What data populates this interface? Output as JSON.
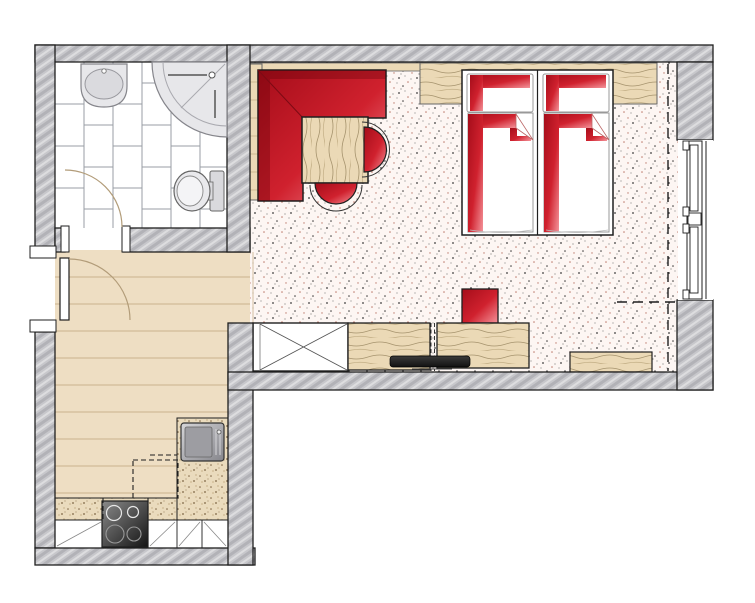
{
  "colors": {
    "outline": "#1f1f1f",
    "wall_base": "#c7c7cb",
    "wall_dark": "#b2b2b7",
    "wall_light": "#dddddf",
    "red_dark": "#a50d1a",
    "red_mid": "#d0212e",
    "red_light": "#f4939a",
    "wood_floor": "#eedec3",
    "wood_floor_line": "#c9b28c",
    "wood_base": "#ebd9b6",
    "wood_grain": "#8d7b54",
    "wood_grain_light": "#c2ae85",
    "carpet_base": "#fdf6f3",
    "carpet_dot_dark": "#3d3d3d",
    "carpet_dot_red": "#bd7b6d",
    "carpet_dot_mid": "#8a8a8a",
    "tile_line": "#989ea4",
    "granite_base": "#eadbbd",
    "granite_dot": "#7d6444",
    "granite_dot_light": "#b09468",
    "fixture_fill": "#e7e7ea",
    "fixture_line": "#85858b",
    "steel_light": "#d6d6d9",
    "steel_dark": "#85858b",
    "cook_light": "#8a8a8a",
    "cook_dark": "#141414",
    "tv_light": "#3c3c3c",
    "tv_dark": "#111111",
    "door_arc": "#b29c79"
  },
  "legend": {
    "drawing_type": "apartment-floor-plan",
    "rooms": [
      "bathroom",
      "entry-hall",
      "kitchenette",
      "bedroom"
    ],
    "bathroom_fixtures": [
      "washbasin",
      "corner-shower",
      "toilet",
      "bathroom-door-swing",
      "tiled-floor"
    ],
    "entry_fixtures": [
      "entry-door",
      "entry-door-swing",
      "wood-plank-floor"
    ],
    "kitchen_fixtures": [
      "kitchen-sink",
      "cooktop",
      "base-cabinets",
      "granite-countertop",
      "upper-cabinet-dashed-outline"
    ],
    "bedroom_fixtures": [
      "corner-bench",
      "dining-table",
      "chair",
      "twin-bed",
      "pillow",
      "duvet",
      "headboard-shelf",
      "stool",
      "wardrobe",
      "sideboard",
      "tv",
      "window-bench",
      "window",
      "curtain-track",
      "carpet-floor"
    ]
  }
}
